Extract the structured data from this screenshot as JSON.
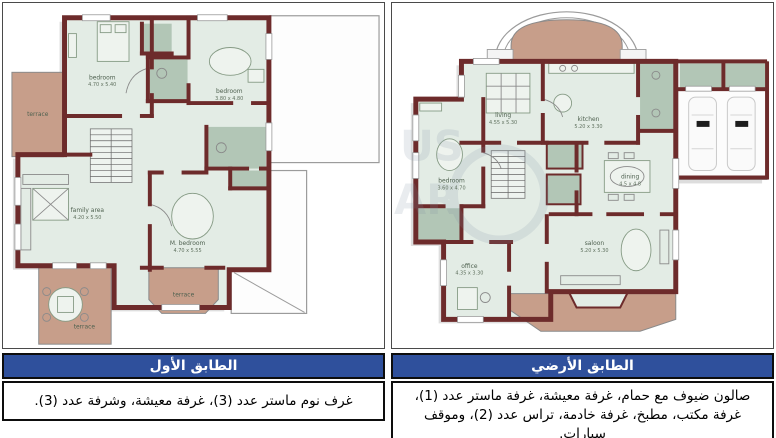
{
  "colors": {
    "wall": "#6d2b2b",
    "floor": "#e3ece5",
    "tile": "#b2c6b6",
    "terrace": "#c79e8a",
    "header_blue": "#2f509c",
    "header_text": "#ffffff",
    "border": "#0d0d0d"
  },
  "left": {
    "title": "الطابق الأول",
    "body": "غرف نوم ماستر عدد (3)، غرفة معيشة، وشرفة عدد (3).",
    "rooms": {
      "bedroom1": {
        "label": "bedroom",
        "dims": "4.70 x 5.40"
      },
      "bedroom2": {
        "label": "bedroom",
        "dims": "3.80 x 4.80"
      },
      "terrace_left": {
        "label": "terrace"
      },
      "family": {
        "label": "family area",
        "dims": "4.20 x 5.50"
      },
      "master": {
        "label": "M. bedroom",
        "dims": "4.70 x 5.55"
      },
      "terrace_bottom_left": {
        "label": "terrace"
      },
      "terrace_bottom_center": {
        "label": "terrace"
      }
    }
  },
  "right": {
    "title": "الطابق الأرضي",
    "body": "صالون ضيوف مع حمام، غرفة معيشة، غرفة ماستر عدد (1)، غرفة مكتب، مطبخ، غرفة خادمة، تراس عدد (2)، وموقف سيارات.",
    "rooms": {
      "living": {
        "label": "living",
        "dims": "4.55 x 5.30"
      },
      "kitchen": {
        "label": "kitchen",
        "dims": "5.20 x 3.30"
      },
      "bedroom": {
        "label": "bedroom",
        "dims": "3.60 x 4.70"
      },
      "dining": {
        "label": "dining",
        "dims": "4.5 x 4.8"
      },
      "saloon": {
        "label": "saloon",
        "dims": "5.20 x 5.30"
      },
      "office": {
        "label": "office",
        "dims": "4.35 x 3.30"
      }
    },
    "watermark": {
      "line1": "US",
      "line2": "AR"
    }
  }
}
